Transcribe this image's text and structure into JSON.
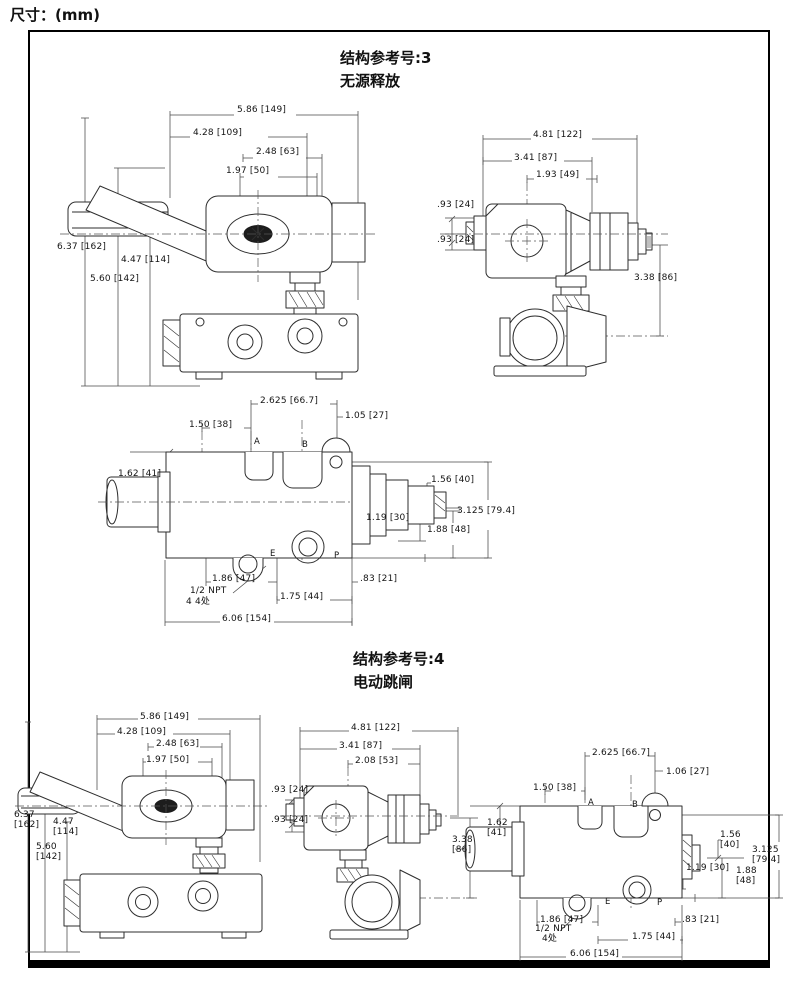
{
  "page": {
    "dim_note": "尺寸：(mm)"
  },
  "sections": [
    {
      "title": "结构参考号:3",
      "subtitle": "无源释放",
      "front": {
        "d1": "5.86 [149]",
        "d2": "4.28 [109]",
        "d3": "2.48 [63]",
        "d4": "1.97 [50]",
        "d5": "6.37 [162]",
        "d6": "4.47 [114]",
        "d7": "5.60 [142]"
      },
      "side": {
        "d1": "4.81 [122]",
        "d2": "3.41 [87]",
        "d3": "1.93 [49]",
        "d4": ".93 [24]",
        "d5": ".93 [24]",
        "d6": "3.38 [86]"
      },
      "port": {
        "d1": "2.625 [66.7]",
        "d2": "1.05 [27]",
        "d3": "1.50 [38]",
        "d4": "1.62 [41]",
        "pa": "A",
        "pb": "B",
        "d5": "1.56 [40]",
        "d6": "3.125 [79.4]",
        "d7": "1.19 [30]",
        "d8": "1.88 [48]",
        "pe": "E",
        "pp": "P",
        "d9": "1.86 [47]",
        "d10": ".83 [21]",
        "d11": "1.75 [44]",
        "npt": "1/2 NPT",
        "npt2": "4 4处",
        "d12": "6.06 [154]"
      }
    },
    {
      "title": "结构参考号:4",
      "subtitle": "电动跳闸",
      "front": {
        "d1": "5.86 [149]",
        "d2": "4.28 [109]",
        "d3": "2.48 [63]",
        "d4": "1.97 [50]",
        "d5": "6.37\n[162]",
        "d6": "4.47\n[114]",
        "d7": "5.60\n[142]"
      },
      "side": {
        "d1": "4.81 [122]",
        "d2": "3.41 [87]",
        "d3": "2.08 [53]",
        "d4": ".93 [24]",
        "d5": ".93 [24]",
        "d6": "3.38\n[86]"
      },
      "port": {
        "d1": "2.625 [66.7]",
        "d2": "1.06 [27]",
        "d3": "1.50 [38]",
        "d4": "1.62\n[41]",
        "pa": "A",
        "pb": "B",
        "d5": "1.56\n[40]",
        "d6": "3.125\n[79.4]",
        "d7": "1.19 [30]",
        "d8": "1.88\n[48]",
        "pe": "E",
        "pp": "P",
        "d9": "1.86 [47]",
        "d10": ".83 [21]",
        "d11": "1.75 [44]",
        "npt": "1/2 NPT",
        "npt2": "4处",
        "d12": "6.06 [154]"
      }
    }
  ]
}
